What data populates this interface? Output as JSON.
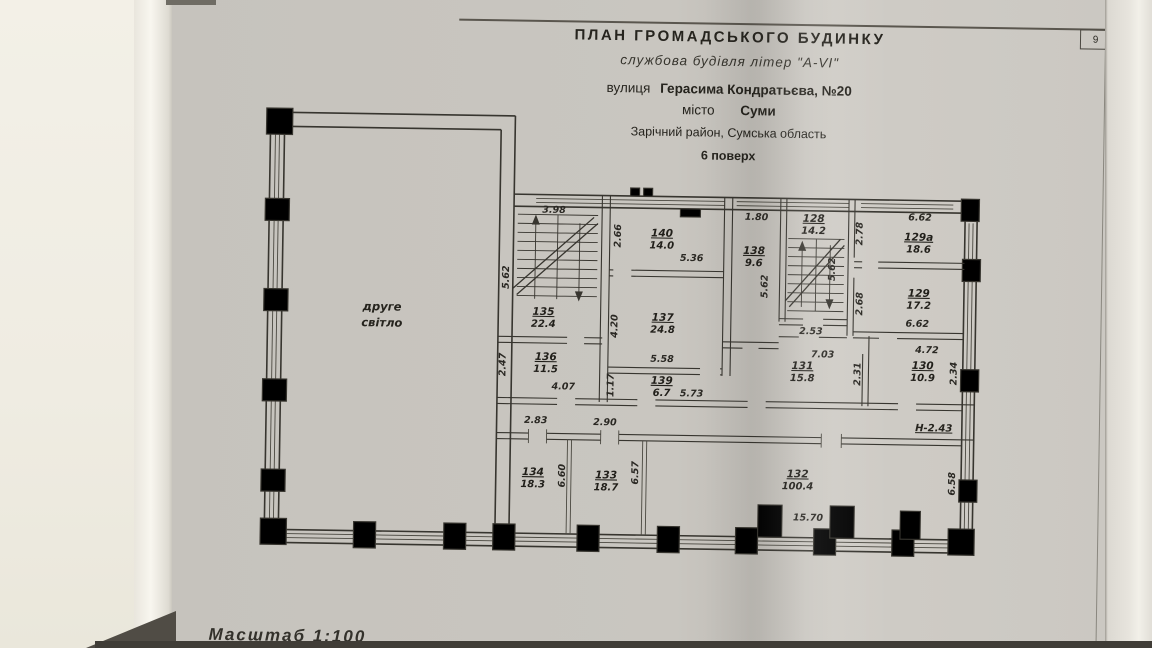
{
  "page": {
    "number": "9",
    "scale": "Масштаб  1:100"
  },
  "title": {
    "line1": "ПЛАН  ГРОМАДСЬКОГО  БУДИНКУ",
    "line2": "службова будівля літер \"А-VI\"",
    "street_label": "вулиця",
    "street_value": "Герасима Кондратьєва, №20",
    "city_label": "місто",
    "city_value": "Суми",
    "district": "Зарічний район, Сумська область",
    "floor": "6 поверх"
  },
  "plan": {
    "void_line1": "друге",
    "void_line2": "світло",
    "height_note": "Н-2.43",
    "rooms": {
      "r135": {
        "no": "135",
        "area": "22.4"
      },
      "r140": {
        "no": "140",
        "area": "14.0"
      },
      "r138": {
        "no": "138",
        "area": "9.6"
      },
      "r128": {
        "no": "128",
        "area": "14.2"
      },
      "r129a": {
        "no": "129а",
        "area": "18.6"
      },
      "r129": {
        "no": "129",
        "area": "17.2"
      },
      "r137": {
        "no": "137",
        "area": "24.8"
      },
      "r136": {
        "no": "136",
        "area": "11.5"
      },
      "r139": {
        "no": "139",
        "area": "6.7"
      },
      "r131": {
        "no": "131",
        "area": "15.8"
      },
      "r130": {
        "no": "130",
        "area": "10.9"
      },
      "r134": {
        "no": "134",
        "area": "18.3"
      },
      "r133": {
        "no": "133",
        "area": "18.7"
      },
      "r132": {
        "no": "132",
        "area": "100.4"
      }
    },
    "dims": {
      "stair135_top": "3.98",
      "stair135_left": "5.62",
      "room140_left": "2.66",
      "room140_width": "5.36",
      "room138_top": "1.80",
      "room138_height": "5.62",
      "stair128_inner": "5.62",
      "stair128_bottom": "2.53",
      "room129a_left": "2.78",
      "room129a_top": "6.62",
      "room129_left": "2.68",
      "room129_bottom": "6.62",
      "room137_left": "4.20",
      "room137_bottom": "5.58",
      "room136_left": "2.47",
      "room136_bottom": "4.07",
      "room139_left": "1.17",
      "room139_right": "5.73",
      "room131_top": "7.03",
      "room131_right": "2.31",
      "room130_top": "4.72",
      "room130_right": "2.34",
      "corridor_a": "2.83",
      "corridor_b": "2.90",
      "room134_height": "6.60",
      "room133_height": "6.57",
      "room132_bottom": "15.70",
      "room132_right": "6.58"
    }
  }
}
